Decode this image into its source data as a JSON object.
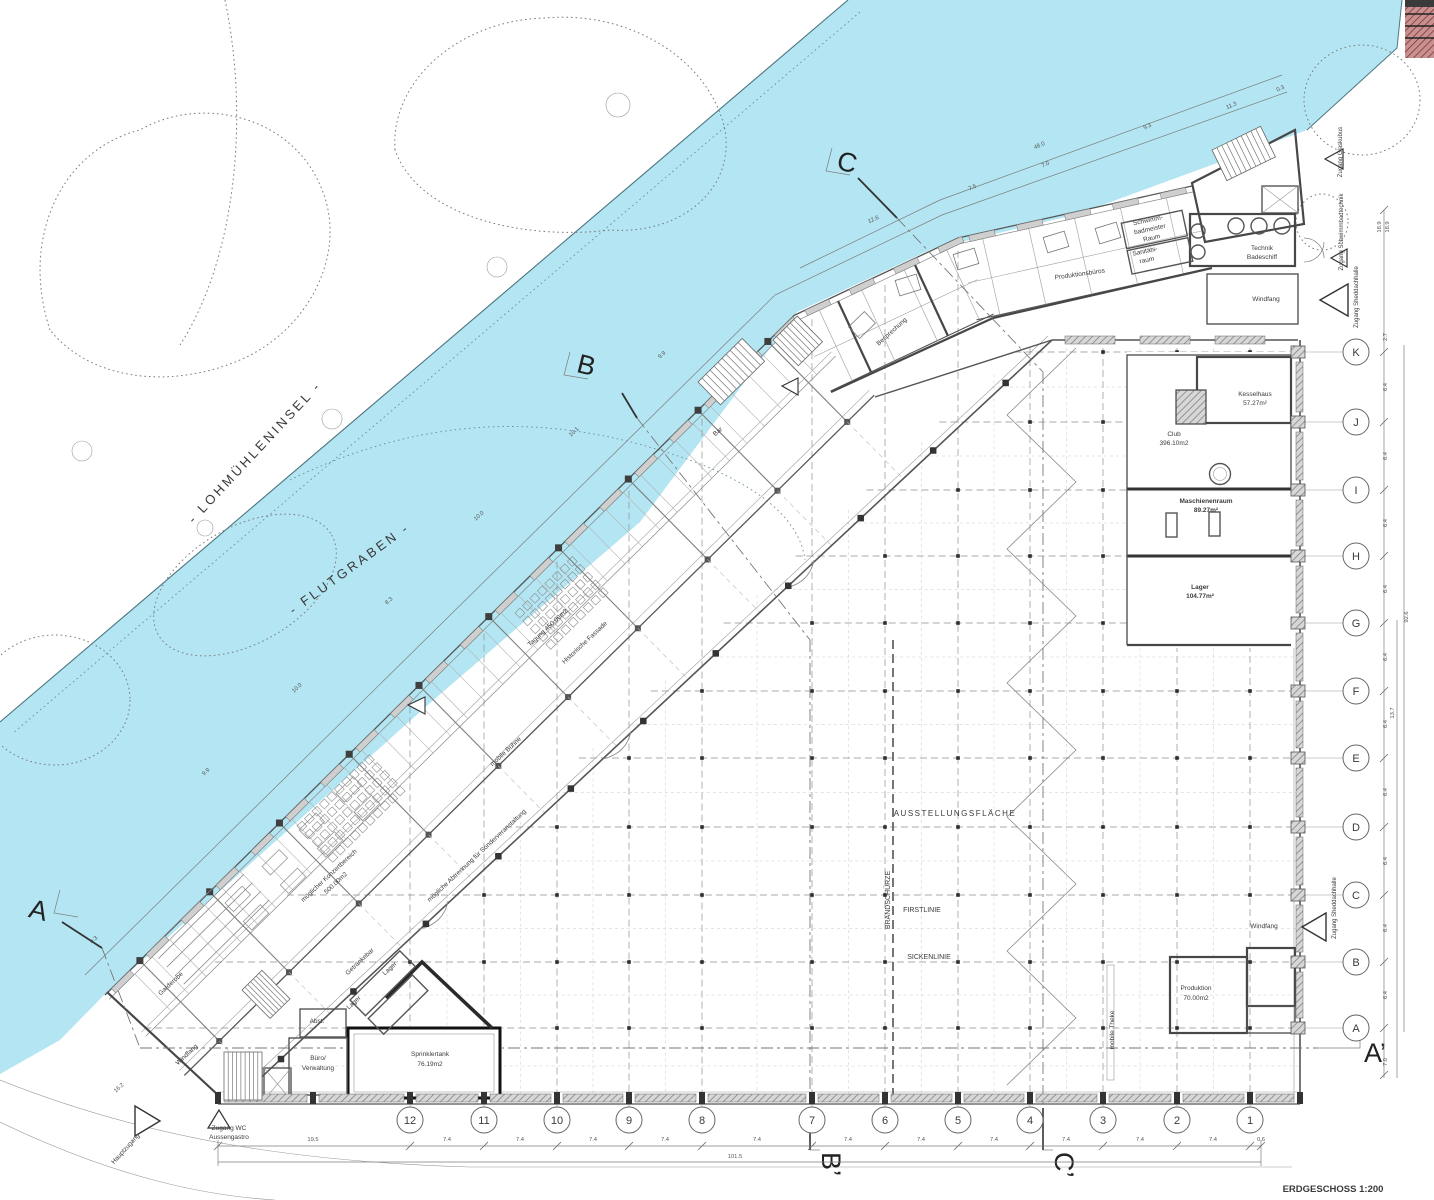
{
  "title": "ERDGESCHOSS 1:200",
  "water": {
    "island_label": "- LOHMÜHLENINSEL -",
    "canal_label": "- FLUTGRABEN -",
    "color": "#b3e6f2"
  },
  "grid": {
    "numbers": [
      "12",
      "11",
      "10",
      "9",
      "8",
      "7",
      "6",
      "5",
      "4",
      "3",
      "2",
      "1"
    ],
    "letters": [
      "K",
      "J",
      "I",
      "H",
      "G",
      "F",
      "E",
      "D",
      "C",
      "B",
      "A"
    ]
  },
  "sections": {
    "top_c": "C",
    "top_b": "B",
    "left_a": "A",
    "right_a": "A’",
    "bottom_b": "B’",
    "bottom_c": "C’"
  },
  "rooms": {
    "schwimmbadmeister": [
      "Schwimm-",
      "badmeister",
      "Raum"
    ],
    "sanitaetsraum": [
      "Sanitäts-",
      "raum"
    ],
    "produktionsbueros": "Produktionsbüros",
    "technik_badeschiff": [
      "Technik",
      "Badeschiff"
    ],
    "windfang_top": "Windfang",
    "besprechung": "Besprechung",
    "bar": "Bar",
    "kesselhaus": [
      "Kesselhaus",
      "57.27m²"
    ],
    "club": [
      "Club",
      "396.10m2"
    ],
    "maschinenraum": [
      "Maschienenraum",
      "89.27m²"
    ],
    "lager_gross": [
      "Lager",
      "104.77m²"
    ],
    "ausstellungsflaeche": "AUSSTELLUNGSFLÄCHE",
    "firstlinie": "FIRSTLINIE",
    "sickenlinie": "SICKENLINIE",
    "brandschuerze": "BRANDSCHÜRZE",
    "mobile_theke": "mobile Theke",
    "windfang_right": "Windfang",
    "produktion": [
      "Produktion",
      "70.00m2"
    ],
    "sprinklertank": [
      "Sprinklertank",
      "76.19m2"
    ],
    "buero_verwaltung": [
      "Büro/",
      "Verwaltung"
    ],
    "abstellraum": "Abst.",
    "lager_1": "Lager",
    "lager_2": "Lager",
    "getraenkebar": "Getränkebar",
    "garderobe": "Garderobe",
    "windfang_left": "Windfang",
    "tagung": "Tagung 450.00m2",
    "historische_fassade": "Historische Fassade",
    "mobile_buehne": "mobile Bühne",
    "konzertbereich": [
      "möglicher Konzertbereich",
      "500.00m2"
    ],
    "abtrennung": "mögliche Abtrennung für Sonderveranstaltung"
  },
  "entrances": {
    "glaskubus": "Zugang Glaskubus",
    "schwimmbadtechnik": "Zugang Schwimmbadtechnik",
    "sheddachhalle_top": "Zugang Sheddachhalle",
    "sheddachhalle_right": "Zugang Sheddachhalle",
    "wc_aussengastro": [
      "Zugang WC",
      "Aussengastro"
    ],
    "hauptzugang": "Hauptzugang"
  },
  "dims": {
    "bottom": [
      "19.5",
      "7.4",
      "7.4",
      "7.4",
      "7.4",
      "7.4",
      "7.4",
      "7.4",
      "7.4",
      "7.4",
      "7.4",
      "7.4",
      "0.6"
    ],
    "bottom_total": "101.5",
    "right": [
      "18.9",
      "18.9",
      "2.7",
      "6.4",
      "6.4",
      "6.4",
      "6.4",
      "6.4",
      "6.4",
      "6.4",
      "6.4",
      "6.4",
      "6.4",
      "7.0"
    ],
    "right_total_1": "92.6",
    "right_total_2": "13.7",
    "top": [
      "12.6",
      "7.5",
      "7.0",
      "48.0",
      "9.3",
      "11.3",
      "0.3"
    ],
    "waterfront": [
      "9.9",
      "10.1",
      "10.0",
      "8.3",
      "10.0",
      "9.9",
      "0.3",
      "16.2"
    ]
  }
}
